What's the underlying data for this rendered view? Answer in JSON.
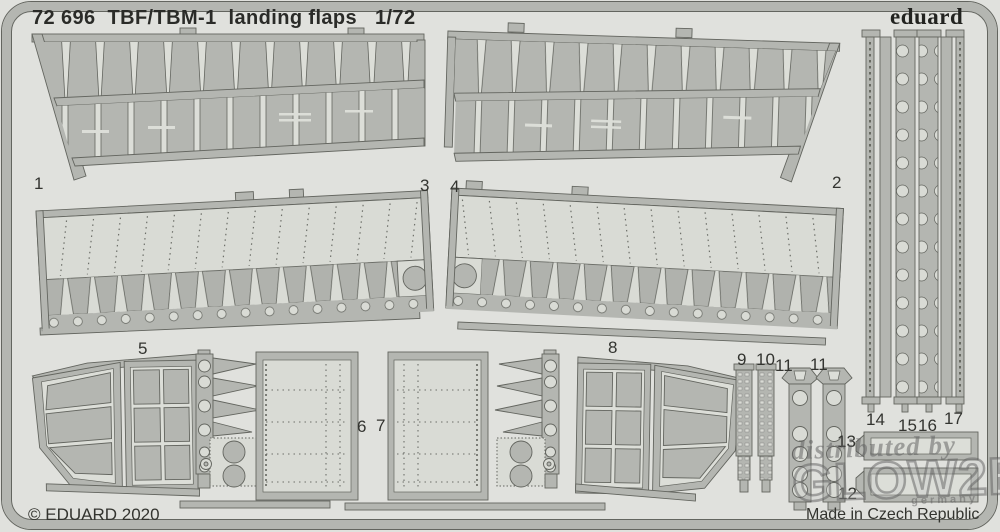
{
  "header": {
    "sheet_title": "72 696  TBF/TBM-1  landing flaps   1/72",
    "brand": "eduard"
  },
  "footer": {
    "copyright": "© EDUARD 2020",
    "origin": "Made in Czech Republic"
  },
  "watermark": {
    "line1": "distributed by",
    "line2": "GLOW2B",
    "line3": "germany"
  },
  "colors": {
    "background": "#e0e1dd",
    "metal": "#b4b6b1",
    "etched_light": "#d9dbd5",
    "outline": "#63655f",
    "text": "#2c2d2a"
  },
  "parts": [
    "1",
    "2",
    "3",
    "4",
    "5",
    "6",
    "7",
    "8",
    "9",
    "10",
    "11",
    "11",
    "12",
    "13",
    "14",
    "15",
    "16",
    "17"
  ]
}
